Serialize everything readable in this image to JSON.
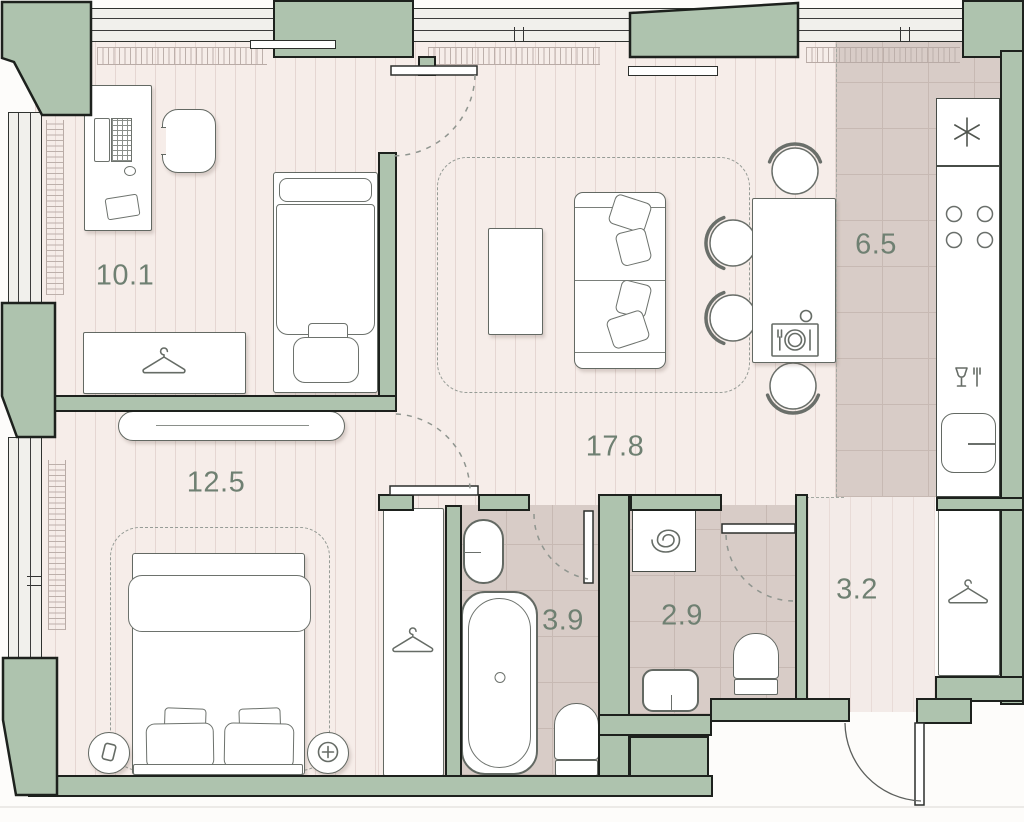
{
  "palette": {
    "wall_fill": "#aec3ae",
    "wall_outline": "#1d211d",
    "floor_plank": "#f6ede9",
    "floor_plank_stripe": "#e5d6d2",
    "floor_hall": "#f3ebe8",
    "floor_hall_stripe": "#e8dbd7",
    "floor_tile": "#d8ccc7",
    "floor_tile_grid": "#c7b9b3",
    "window_glass_bg": "#f1f0ec",
    "furniture_outline": "#636963",
    "label_color": "#6f8072",
    "dash_color": "#969c96"
  },
  "rooms": {
    "office": {
      "area": "10.1"
    },
    "living": {
      "area": "17.8"
    },
    "kitchen": {
      "area": "6.5"
    },
    "bedroom": {
      "area": "12.5"
    },
    "bathroom": {
      "area": "3.9"
    },
    "wc": {
      "area": "2.9"
    },
    "hall": {
      "area": "3.2"
    }
  },
  "icons": {
    "fridge": "asterisk-snowflake",
    "washing_machine": "spiral-drum",
    "wardrobes": "clothes-hanger",
    "dining_table": "place-setting",
    "kitchen_cabinet": "wine-glass-and-fork",
    "nightstand_left": "phone",
    "nightstand_right": "plus-lamp",
    "stove": "four-burners"
  }
}
